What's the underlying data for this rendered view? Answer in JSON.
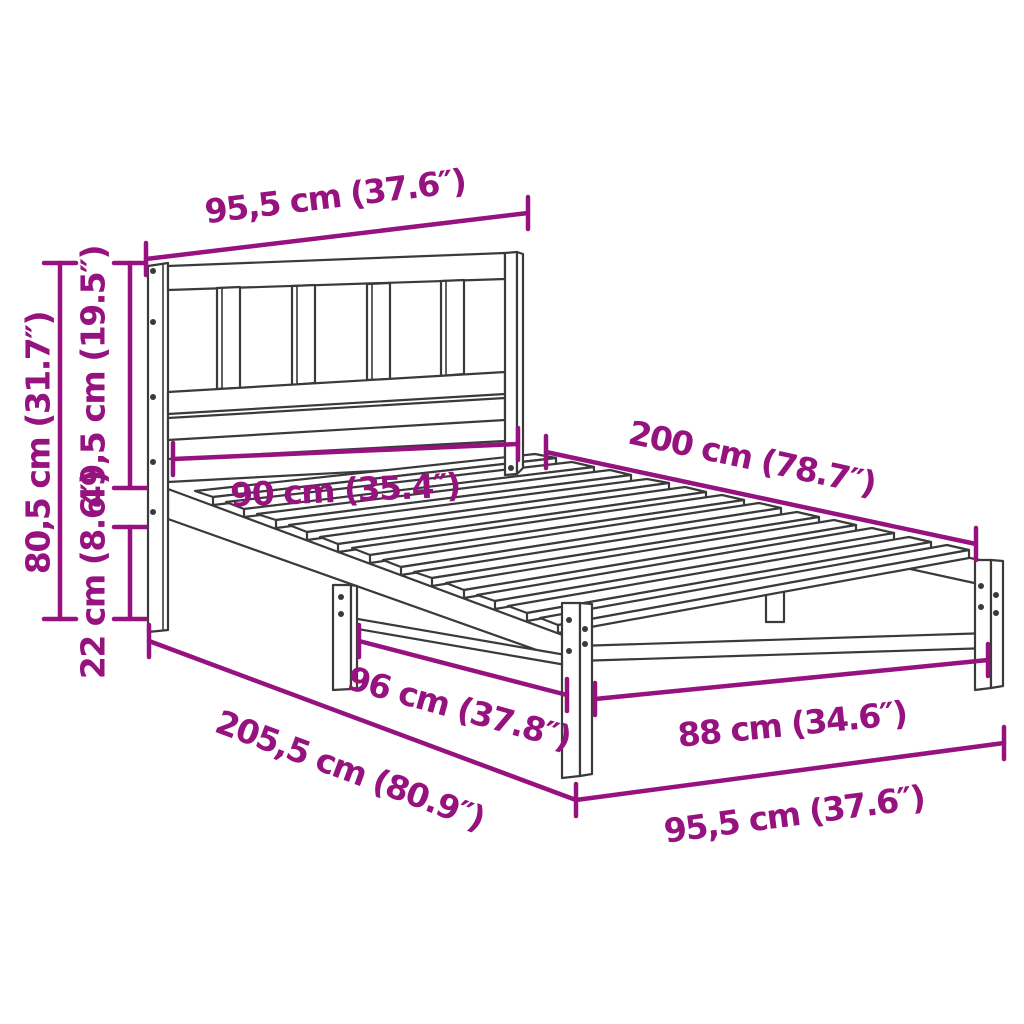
{
  "diagram": {
    "type": "product-dimension-diagram",
    "colors": {
      "dimension_accent": "#96127F",
      "outline": "#3A3A3A",
      "background": "#FFFFFF"
    },
    "dimensions": {
      "headboard_width": "95,5 cm (37.6″)",
      "overall_height": "80,5 cm (31.7″)",
      "headboard_height": "49,5 cm (19.5″)",
      "side_rail_height": "22 cm (8.6″)",
      "inner_width_head": "90 cm (35.4″)",
      "mattress_length": "200 cm (78.7″)",
      "leg_spacing": "96 cm (37.8″)",
      "inner_width_foot": "88 cm (34.6″)",
      "overall_length": "205,5 cm (80.9″)",
      "foot_width": "95,5 cm (37.6″)"
    }
  }
}
